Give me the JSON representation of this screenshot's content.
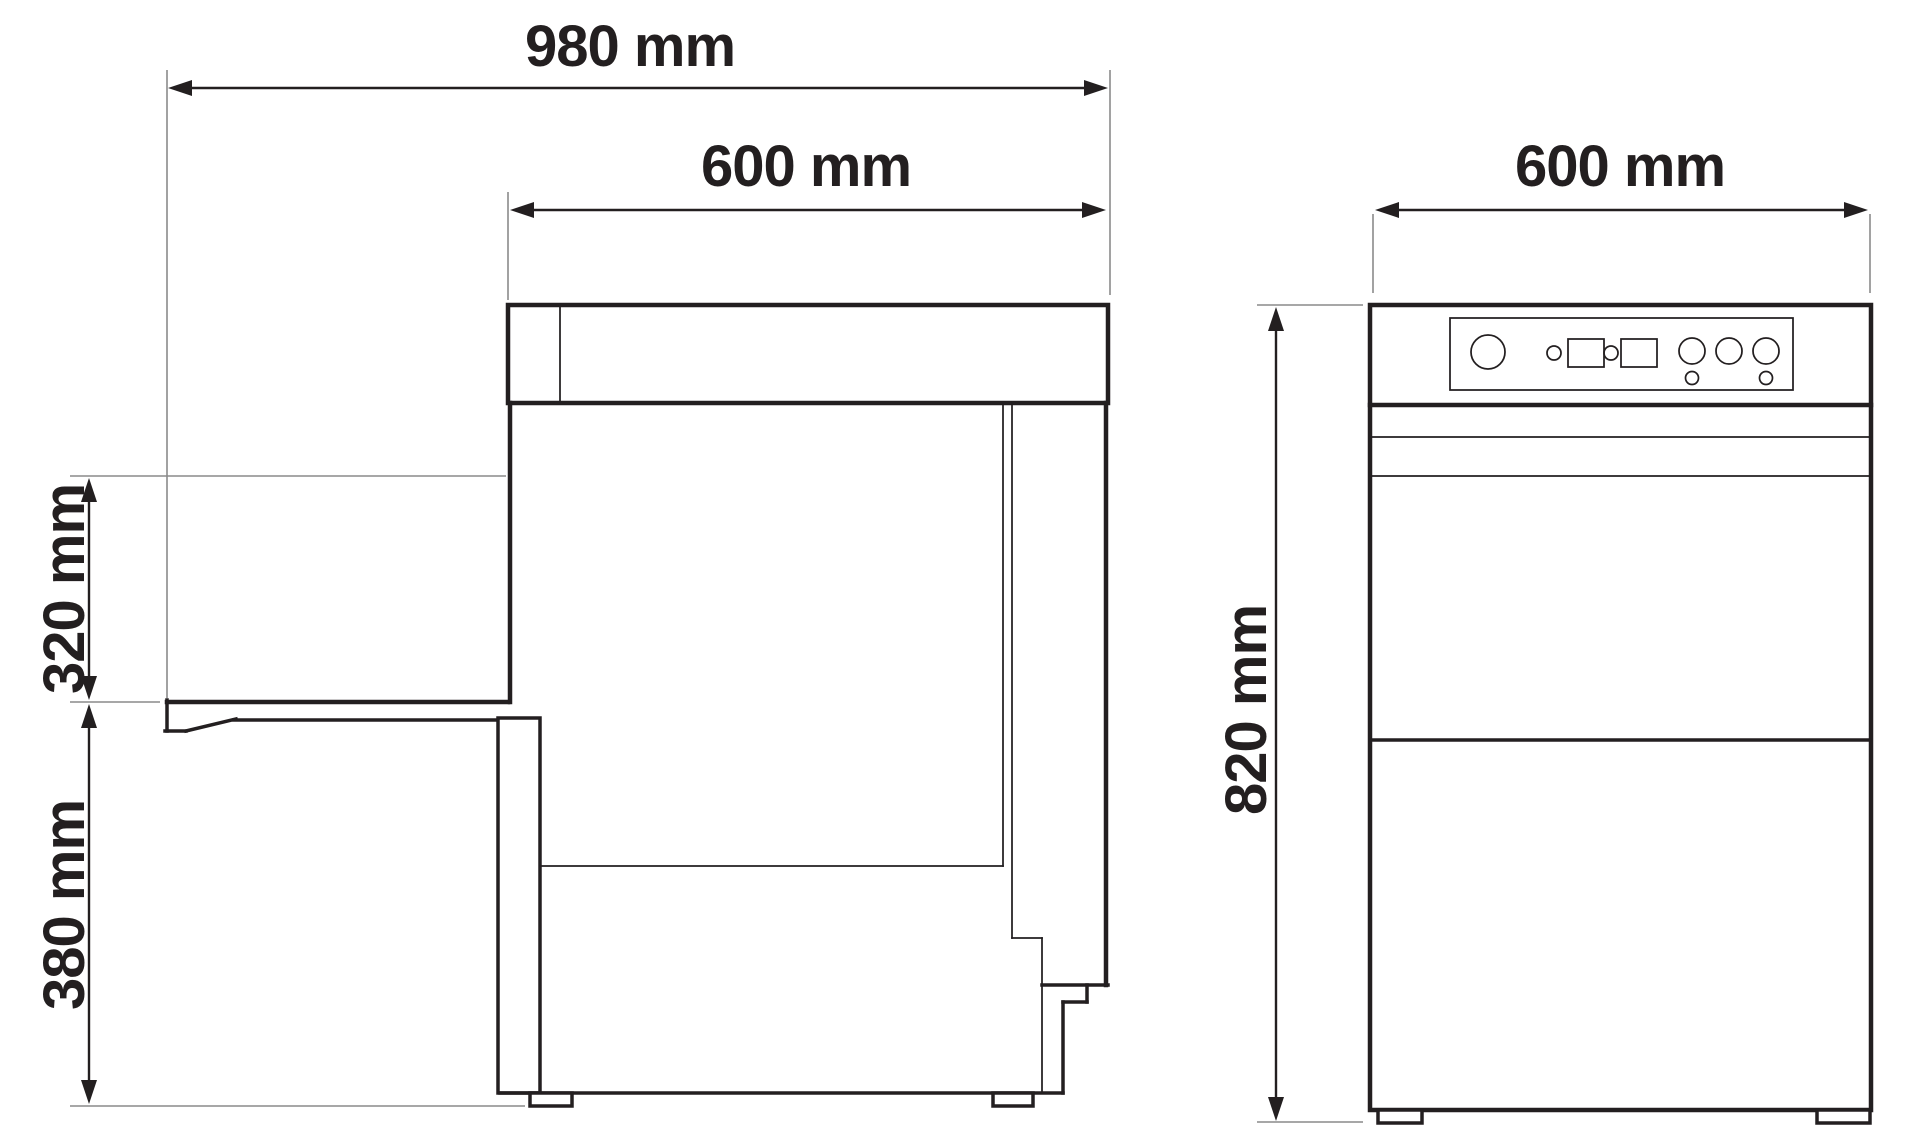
{
  "diagram": {
    "type": "technical-drawing",
    "subject": "undercounter dishwasher - side and front elevation views with dimensions",
    "side_view": {
      "labels": {
        "overall_depth": "980 mm",
        "body_depth": "600 mm",
        "opening_height": "320 mm",
        "base_height": "380 mm"
      }
    },
    "front_view": {
      "labels": {
        "width": "600 mm",
        "height": "820 mm"
      }
    },
    "colors": {
      "line": "#231f20",
      "reference_line": "#8a8a8a",
      "background": "#ffffff"
    }
  }
}
